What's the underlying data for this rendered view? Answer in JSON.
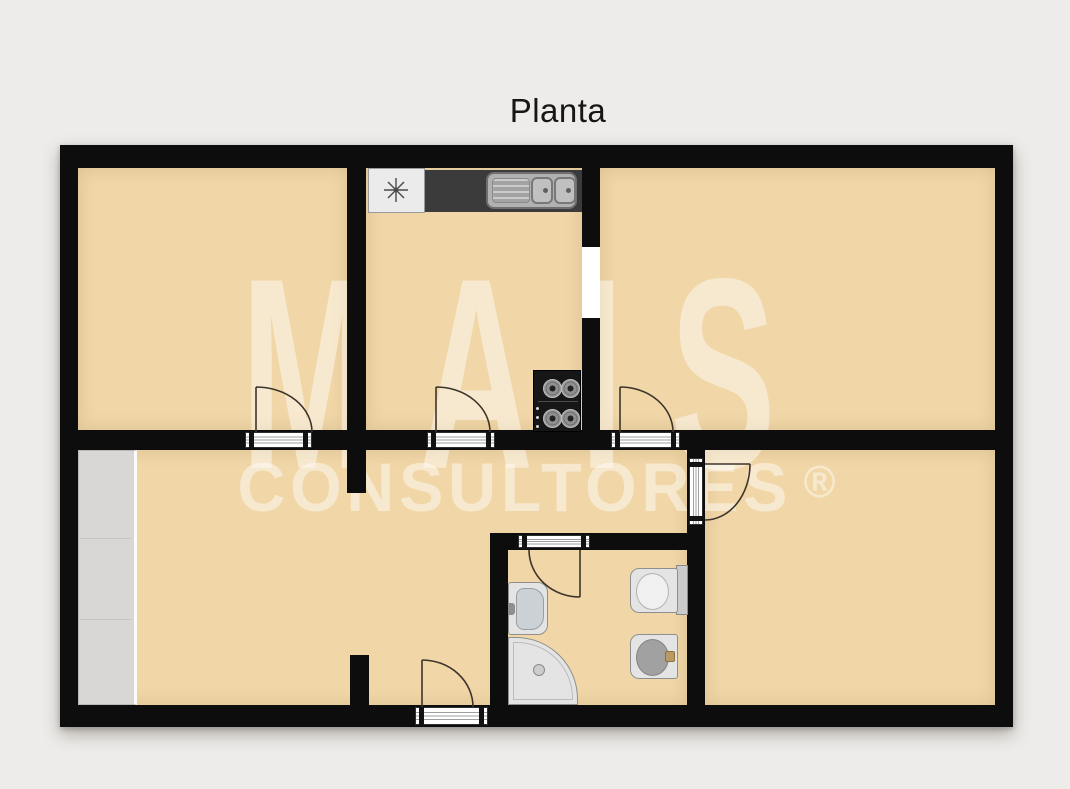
{
  "title": "Planta",
  "watermark": {
    "brand": "MAIS",
    "subtitle": "CONSULTORES",
    "registered_mark": "®"
  },
  "colors": {
    "background": "#edecea",
    "wall": "#0d0d0d",
    "floor": "#f1d7a8",
    "wardrobe": "#d8d7d5",
    "counter": "#3b3b3b",
    "fixture_light": "#e4e4e4",
    "sill_frame": "#2f2f2f",
    "door_swing": "#3d342b",
    "watermark_text": "rgba(255,255,255,0.45)"
  },
  "fixtures": [
    "wardrobe",
    "washing-machine",
    "kitchen-counter",
    "kitchen-double-sink",
    "cooktop",
    "washbasin",
    "shower-tray",
    "toilet",
    "bidet"
  ]
}
